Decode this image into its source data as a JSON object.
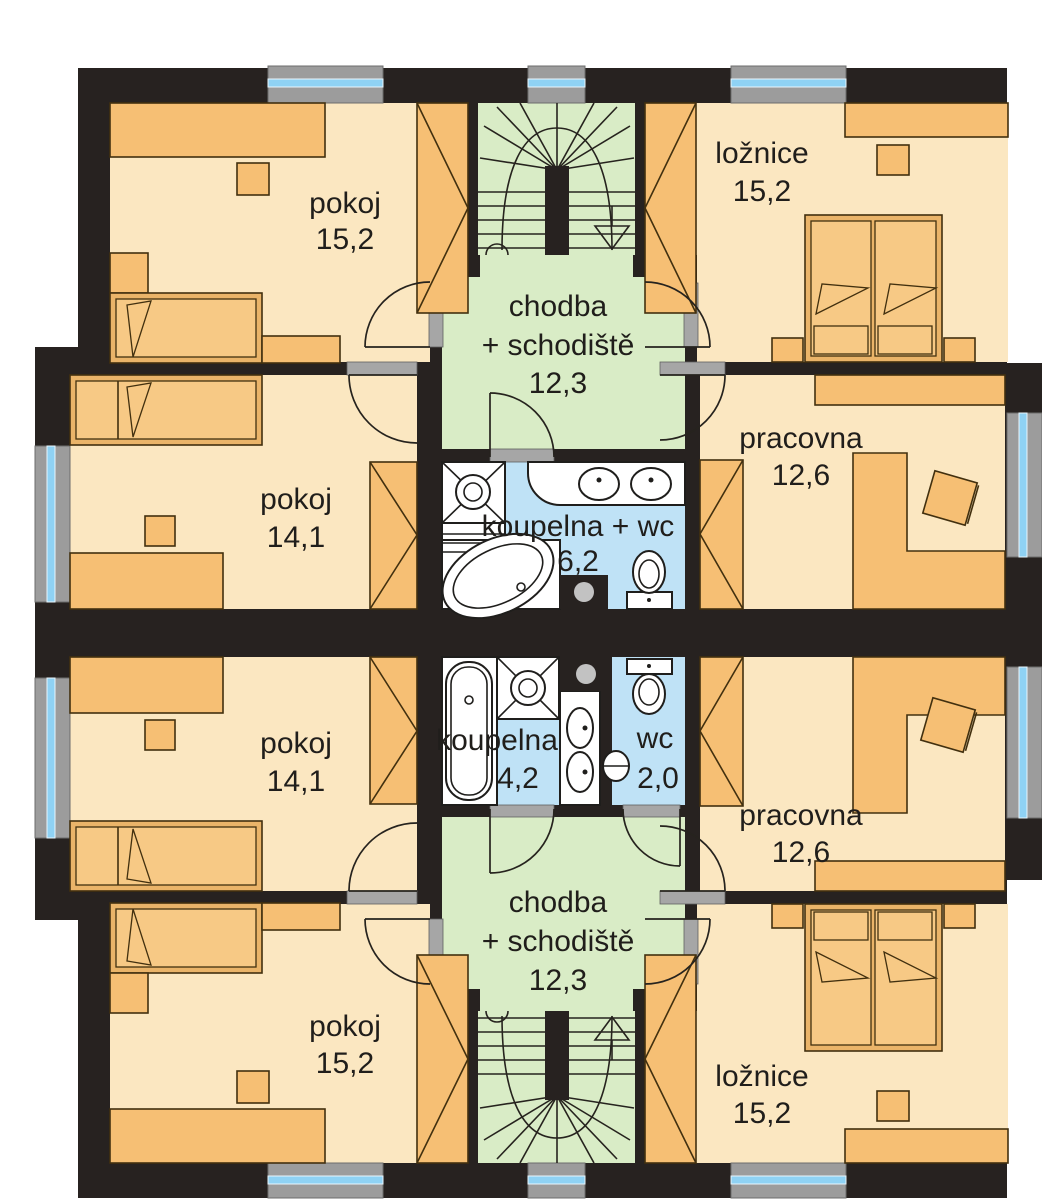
{
  "plan": {
    "type": "floor-plan",
    "language": "cs",
    "colors": {
      "wall": "#272220",
      "room_floor": "#fbe7c1",
      "furniture": "#f6bf74",
      "hall_floor": "#d9ecc6",
      "bath_floor": "#bfe2f6",
      "window_glass": "#8fd2f4",
      "window_frame": "#9c9c9c",
      "fixture_white": "#ffffff"
    },
    "rooms": {
      "u1_pokoj_tl": {
        "label": "pokoj",
        "area": "15,2"
      },
      "u1_loznice": {
        "label": "ložnice",
        "area": "15,2"
      },
      "u1_chodba": {
        "line1": "chodba",
        "line2": "+ schodiště",
        "area": "12,3"
      },
      "u1_pokoj_ml": {
        "label": "pokoj",
        "area": "14,1"
      },
      "u1_pracovna": {
        "label": "pracovna",
        "area": "12,6"
      },
      "u1_koupelna": {
        "label": "koupelna + wc",
        "area": "6,2"
      },
      "u2_koupelna": {
        "label": "koupelna",
        "area": "4,2"
      },
      "u2_wc": {
        "label": "wc",
        "area": "2,0"
      },
      "u2_pokoj_ml": {
        "label": "pokoj",
        "area": "14,1"
      },
      "u2_pracovna": {
        "label": "pracovna",
        "area": "12,6"
      },
      "u2_chodba": {
        "line1": "chodba",
        "line2": "+ schodiště",
        "area": "12,3"
      },
      "u2_pokoj_bl": {
        "label": "pokoj",
        "area": "15,2"
      },
      "u2_loznice": {
        "label": "ložnice",
        "area": "15,2"
      }
    }
  }
}
